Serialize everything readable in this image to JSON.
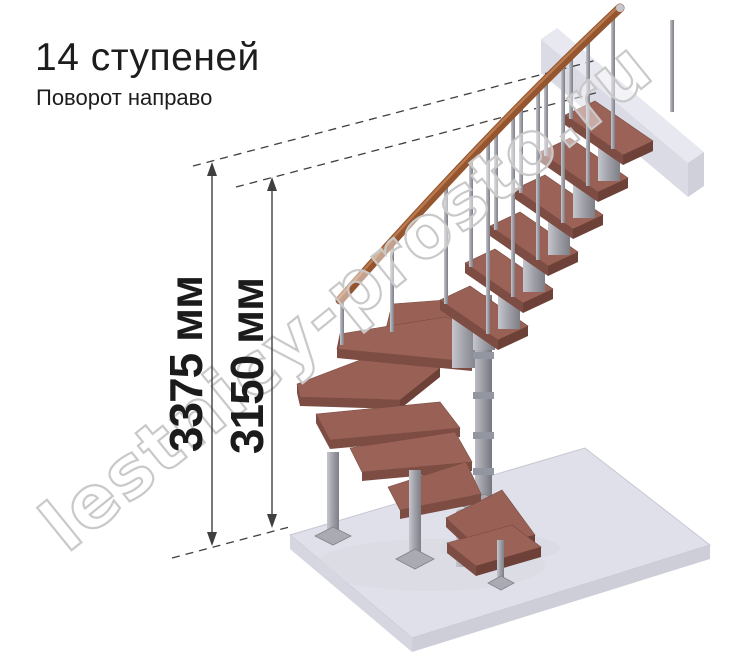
{
  "header": {
    "title": "14 ступеней",
    "subtitle": "Поворот направо"
  },
  "dimensions": {
    "total_height": "3375 мм",
    "height_to_top_step": "3150 мм"
  },
  "watermark": "lestnicy-prosto.ru",
  "render": {
    "description": "3D render of a modular staircase with winder steps, right turn, central pole, wooden treads and handrail, metal balusters, floor slab and upper floor beam",
    "steps_count": 14,
    "turn": "right",
    "colors": {
      "tread_top": "#996156",
      "tread_front": "#7d4c43",
      "tread_side": "#6d4038",
      "handrail": "#94552f",
      "metal_light": "#c6c6ce",
      "metal_dark": "#82828a",
      "floor_top": "#dfe0e9",
      "floor_front": "#cdced8",
      "beam_front": "#dadbe5",
      "dimension_line": "#3f3f3f",
      "text": "#1d1d1d",
      "watermark_stroke": "#c9c9c9"
    }
  }
}
